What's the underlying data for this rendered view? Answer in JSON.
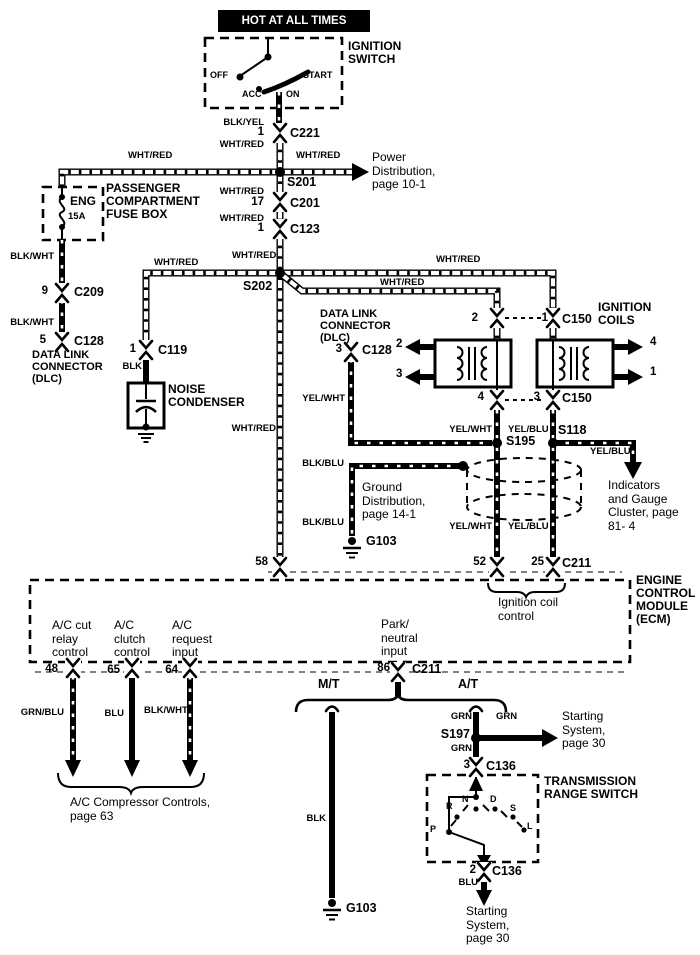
{
  "header": {
    "hot": "HOT AT ALL TIMES"
  },
  "ignition_switch": {
    "label": "IGNITION SWITCH",
    "off": "OFF",
    "acc": "ACC",
    "on": "ON",
    "start": "START"
  },
  "fuse_box": {
    "label": "PASSENGER COMPARTMENT FUSE BOX",
    "fuse": "ENG",
    "rating": "15A"
  },
  "components": {
    "dlc_left": "DATA LINK CONNECTOR (DLC)",
    "dlc_mid": "DATA LINK CONNECTOR (DLC)",
    "noise_condenser": "NOISE CONDENSER",
    "ignition_coils": "IGNITION COILS",
    "ecm": "ENGINE CONTROL MODULE (ECM)",
    "trs": "TRANSMISSION RANGE SWITCH"
  },
  "ecm_labels": {
    "ignition_input": "Ignition input",
    "ignition_coil_control": "Ignition coil control",
    "park_neutral_input": "Park/ neutral input",
    "ac_cut_relay": "A/C cut relay control",
    "ac_clutch": "A/C clutch control",
    "ac_request": "A/C request input"
  },
  "branches": {
    "mt": "M/T",
    "at": "A/T"
  },
  "trs_positions": {
    "p": "P",
    "r": "R",
    "n": "N",
    "d": "D",
    "s": "S",
    "l": "L"
  },
  "wires": {
    "wht_red": "WHT/RED",
    "blk_yel": "BLK/YEL",
    "blk_wht": "BLK/WHT",
    "blk": "BLK",
    "yel_wht": "YEL/WHT",
    "yel_blu": "YEL/BLU",
    "blk_blu": "BLK/BLU",
    "grn_blu": "GRN/BLU",
    "grn": "GRN",
    "blu": "BLU"
  },
  "connectors": {
    "c221": "C221",
    "c201": "C201",
    "c123": "C123",
    "c209": "C209",
    "c128": "C128",
    "c119": "C119",
    "c150": "C150",
    "c211": "C211",
    "c136": "C136"
  },
  "splices": {
    "s201": "S201",
    "s202": "S202",
    "s195": "S195",
    "s118": "S118",
    "s197": "S197"
  },
  "grounds": {
    "g103": "G103"
  },
  "pins": {
    "p1": "1",
    "p2": "2",
    "p3": "3",
    "p4": "4",
    "p5": "5",
    "p9": "9",
    "p17": "17",
    "p25": "25",
    "p48": "48",
    "p52": "52",
    "p58": "58",
    "p64": "64",
    "p65": "65",
    "p86": "86"
  },
  "refs": {
    "power_distribution": "Power Distribution, page 10-1",
    "ground_distribution": "Ground Distribution, page 14-1",
    "indicators": "Indicators and Gauge Cluster, page 81- 4",
    "ac_compressor": "A/C Compressor Controls, page 63",
    "starting_system": "Starting System, page 30"
  }
}
